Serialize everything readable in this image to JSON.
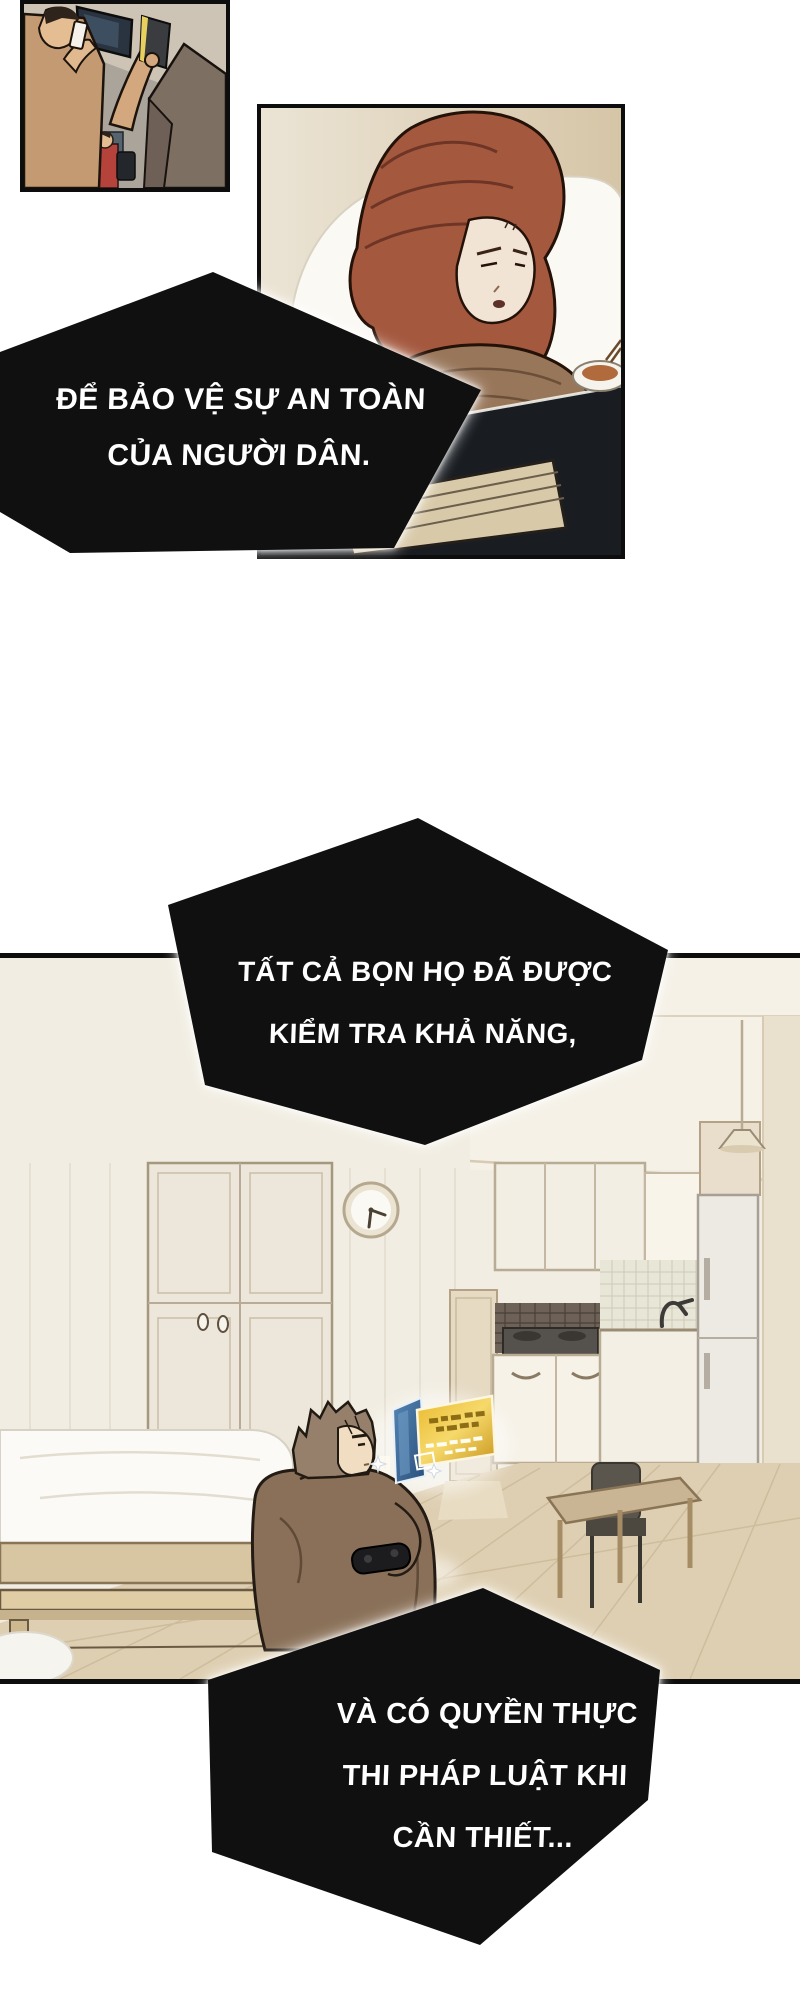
{
  "speech": {
    "bubble1": {
      "lines": [
        "ĐỂ BẢO VỆ SỰ AN TOÀN",
        "CỦA NGƯỜI DÂN."
      ]
    },
    "bubble2": {
      "lines": [
        "TẤT CẢ BỌN HỌ ĐÃ ĐƯỢC",
        "KIỂM TRA KHẢ NĂNG,"
      ]
    },
    "bubble3": {
      "lines": [
        "VÀ CÓ QUYỀN THỰC",
        "THI PHÁP LUẬT KHI",
        "CẦN THIẾT..."
      ]
    }
  },
  "colors": {
    "page_bg": "#ffffff",
    "bubble_bg": "#101010",
    "bubble_text": "#ffffff",
    "panel_border": "#0d0d0d",
    "notification_gold": "#e7b62e",
    "hologram_blue": "#41688f",
    "floor_wood": "#decfb2",
    "wall_cream": "#f1ede2",
    "hair_auburn": "#a4593f",
    "sweater_brown": "#8a7058"
  }
}
